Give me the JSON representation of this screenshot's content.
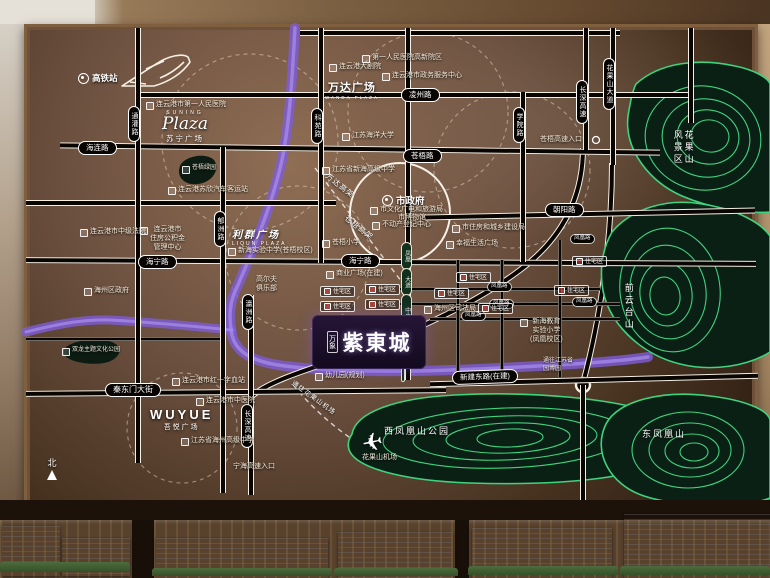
{
  "board_title": "区位图",
  "project": {
    "badge": "万象",
    "name": "紫東城",
    "kindergarten": "幼儿园(规划)"
  },
  "roads": {
    "hailian": "海连路",
    "tongguan": "通灌路",
    "lingzhou": "凌州路",
    "keyuan": "科苑路",
    "cangwu": "苍梧路",
    "haining": "海宁路",
    "chaoyang": "朝阳路",
    "xueyuan": "学院路",
    "changshen": "长深高速",
    "huaguoshan_dadao": "花果山大道",
    "yuzhou": "郁洲路",
    "yingzhou": "瀛洲路",
    "qindongmen": "秦东门大街",
    "xinjian": "新建东路(在建)",
    "wanda_viaduct": "万达高架",
    "cangwu_viaduct": "苍梧高架",
    "fh1": "凤凰",
    "fh2": "大道",
    "fh3": "中央景观带",
    "minor": "凤凰路",
    "cangwu_entrance": "苍梧高速入口",
    "ninghai_entrance": "宁海高速入口",
    "to_airport": "通往花果山机场"
  },
  "landmarks": {
    "gaotiezhan": "高铁站",
    "suning_en": "SUNING",
    "suning_script": "Plaza",
    "suning_cn": "苏宁广场",
    "wanda_cn": "万达广场",
    "wanda_en": "WANDA PLAZA",
    "liqun_cn": "利群广场",
    "liqun_en": "LIQUN PLAZA",
    "wuyue_en": "WUYUE",
    "wuyue_cn": "吾悦广场",
    "city_gov": "市政府",
    "airport": "花果山机场",
    "north": "北"
  },
  "pois": {
    "hosp1": "连云港市第一人民医院",
    "bus": "连云港苏欣汽车客运站",
    "theater": "连云港大剧院",
    "hosp_gx": "第一人民医院高新院区",
    "zwfw": "连云港市政务服务中心",
    "ocean_univ": "江苏海洋大学",
    "xinhai_hs": "江苏省新海高级中学",
    "cangwu_ps": "苍梧小学",
    "culture": "市文化广电和旅游局",
    "museum": "市博物馆",
    "reg": "不动产登记中心",
    "housing": "市住房和城乡建设局",
    "life_plaza": "幸福生活广场",
    "xinhai_exp": "新海实验中学(苍梧校区)",
    "court": "连云港市中级法院",
    "gjj": "连云港市\n住房公积金\n管理中心",
    "haizhou_gov": "海州区政府",
    "golf": "高尔夫\n俱乐部",
    "biz_plaza": "商业广场(在建)",
    "resi": "住宅区",
    "justice": "海州区司法局",
    "primary": "新海教育\n实验小学\n(凤凰校区)",
    "tongwang": "通往江苏省\n园博园",
    "blood": "连云港市红十字血站",
    "tcm": "连云港市中医院",
    "haizhou_hs": "江苏省海州高级中学"
  },
  "parks": {
    "cangwu_green": "苍梧绿园",
    "shuanglong": "双龙主题文化公园",
    "huaguoshan": "花果山\n风景区",
    "qianyuntai": "前云台山",
    "xifenghuang": "西凤凰山公园",
    "dongfenghuang": "东凤凰山"
  },
  "colors": {
    "contour_green": "#3ed37f",
    "river_purple": "#8a68e0",
    "board_brown": "#6d5140",
    "project_purple": "#1a0f2c"
  }
}
